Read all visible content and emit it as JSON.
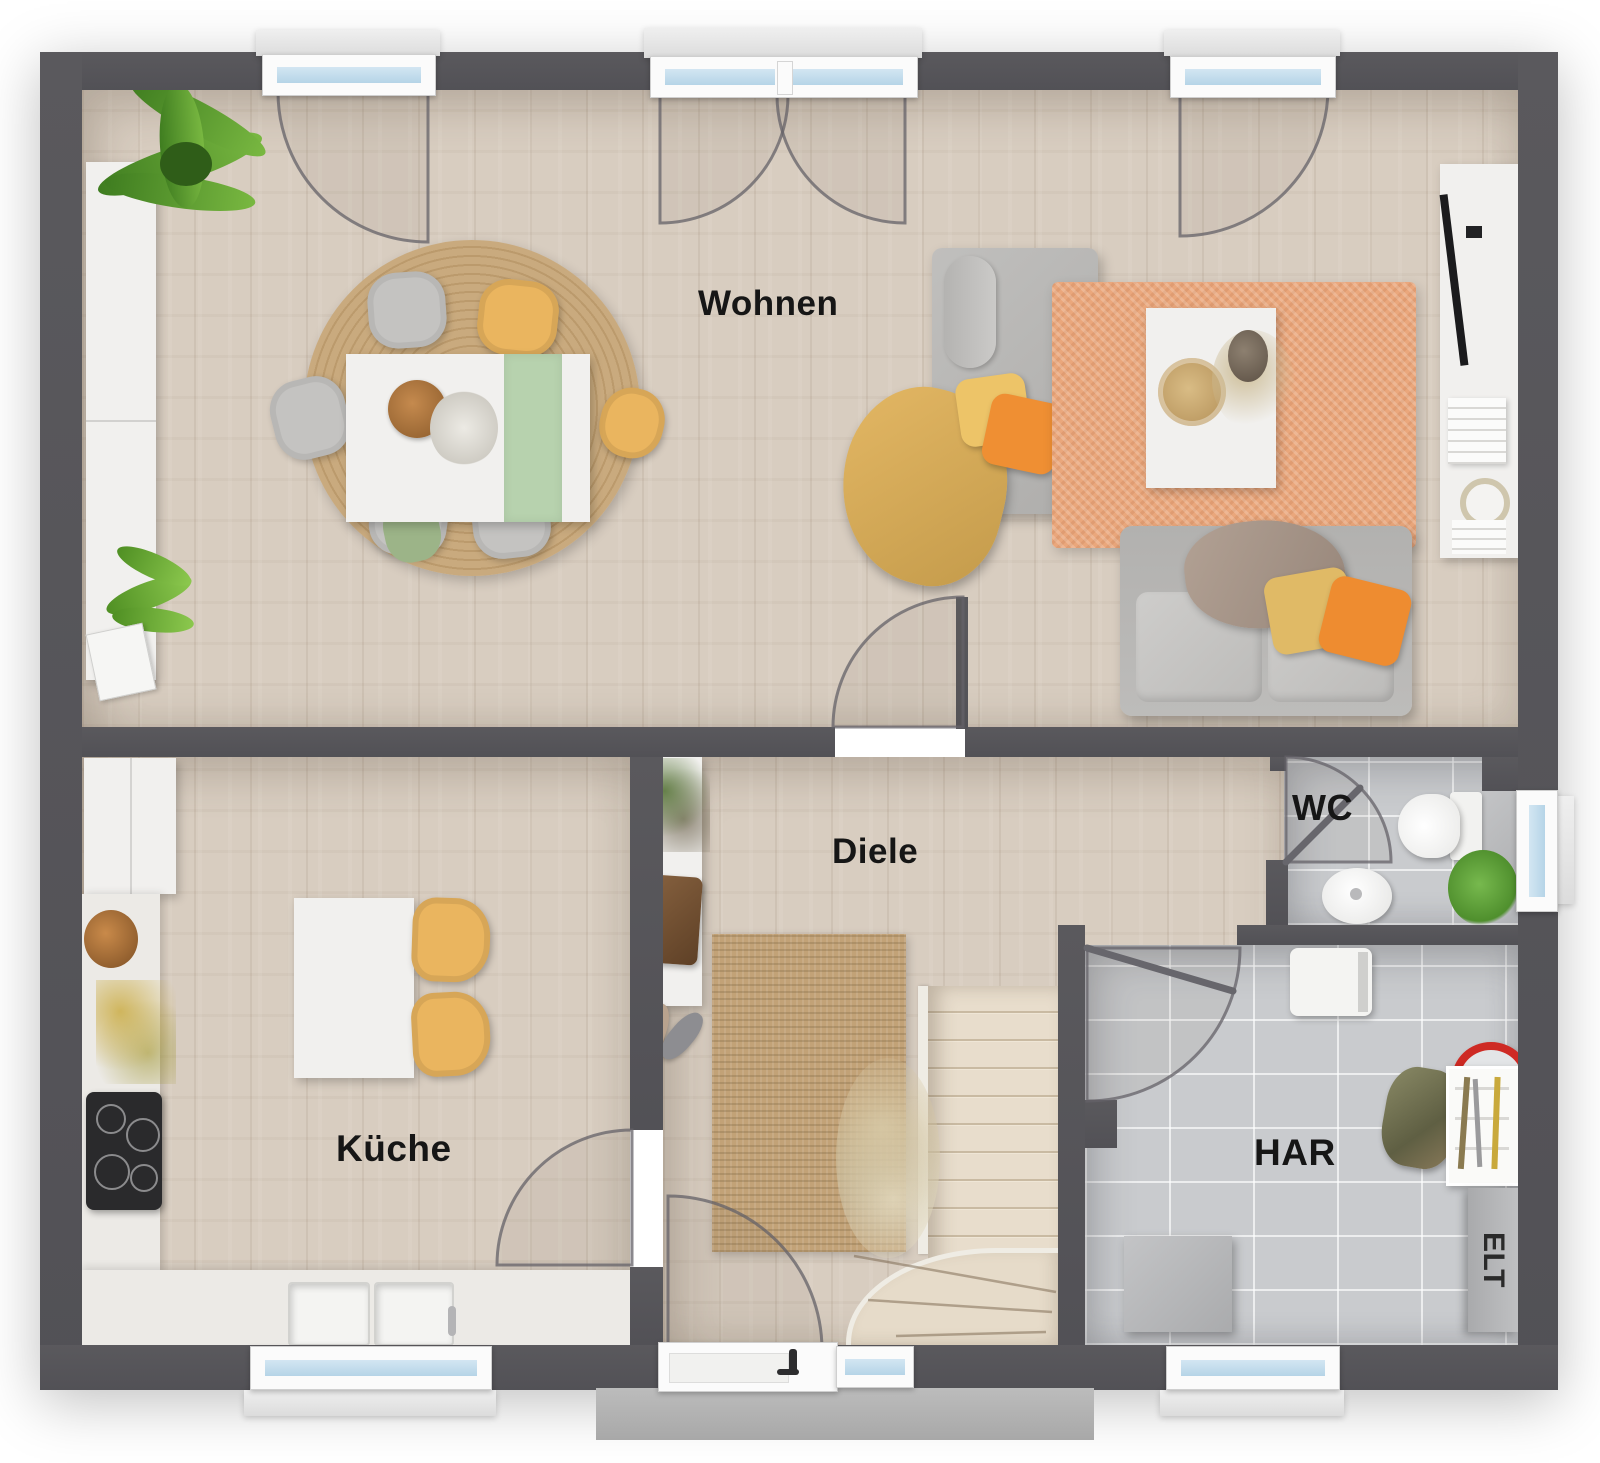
{
  "rooms": {
    "wohnen": {
      "label": "Wohnen"
    },
    "diele": {
      "label": "Diele"
    },
    "kueche": {
      "label": "Küche"
    },
    "wc": {
      "label": "WC"
    },
    "har": {
      "label": "HAR"
    },
    "elt": {
      "label": "ELT"
    }
  },
  "colors": {
    "wall": "#57565a",
    "wood_floor": "#d8cdc0",
    "tile_floor": "#c9cbce",
    "rug_jute": "#c2a277",
    "rug_peach": "#eaa77c",
    "accent_yellow": "#eab55f",
    "accent_orange": "#ee8c30",
    "window_glass": "#c3dcec",
    "plant_green": "#5e9c33"
  }
}
